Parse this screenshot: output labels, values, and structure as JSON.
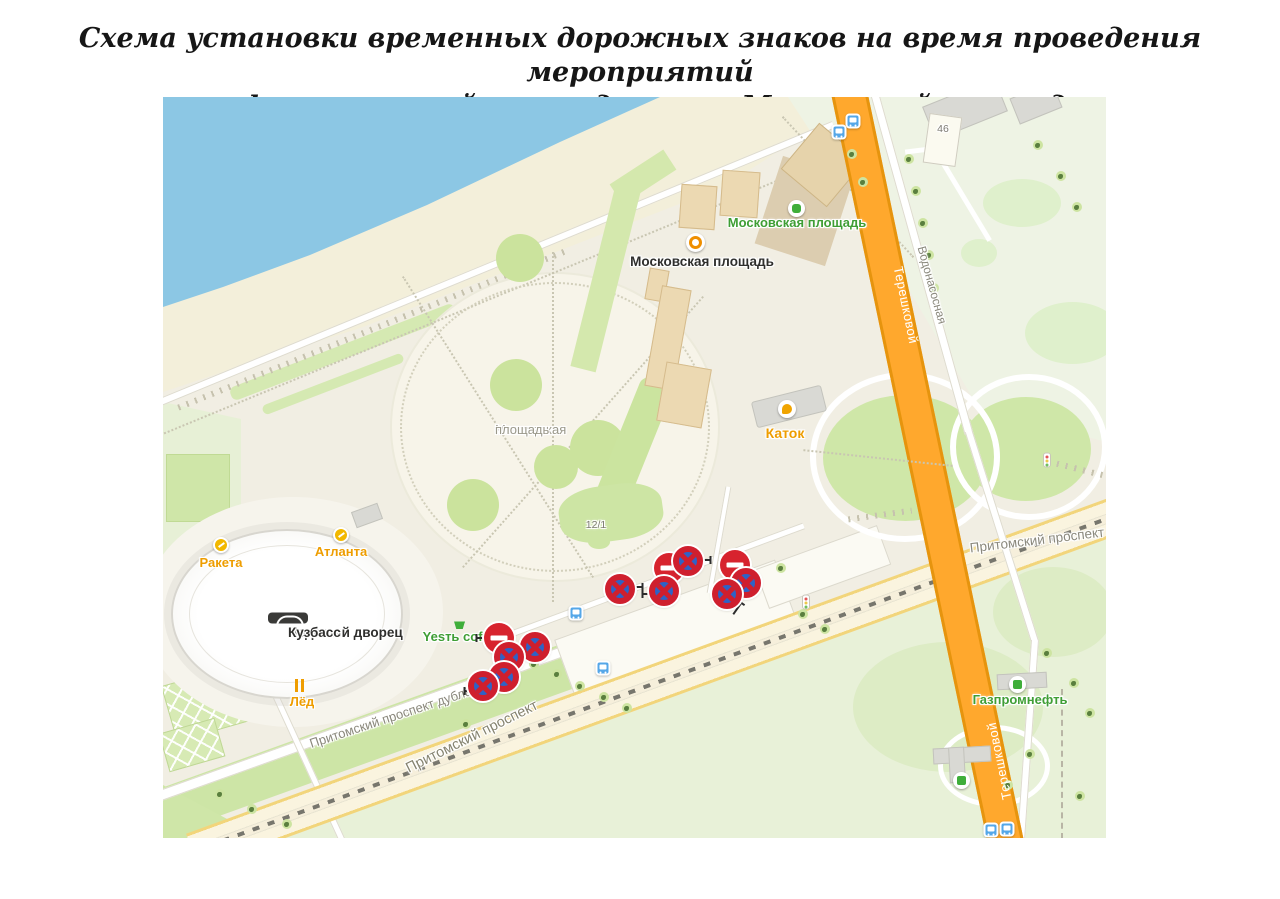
{
  "page": {
    "title_line1": "Схема установки временных дорожных знаков на время проведения мероприятий",
    "title_line2": "на фестивальной площади около Московской площади"
  },
  "map": {
    "poi": {
      "moskovskaya_green": "Московская площадь",
      "moskovskaya_black": "Московская площадь",
      "moskovskaya_plaza_line1": "Московская",
      "moskovskaya_plaza_line2": "площадь",
      "katok": "Каток",
      "raketa": "Ракета",
      "atlanta": "Атланта",
      "ledovy_line1": "Ледовый дворец",
      "ledovy_line2": "Кузбасс",
      "led": "Лёд",
      "yest_coffee": "Yesть coffee",
      "gazprom": "Газпромнефть",
      "house_46": "46",
      "house_12_1": "12/1"
    },
    "roads": {
      "tereshkovoy_top": "Терешковой",
      "tereshkovoy_bottom": "Терешковой",
      "vodonasosnaya": "Водонасосная",
      "pritomsky_dubler": "Притомский проспект дублёр",
      "pritomsky_left": "Притомский проспект",
      "pritomsky_right": "Притомский проспект"
    },
    "icons": {
      "moskovskaya_green_icon": "transit-stop",
      "moskovskaya_black_icon": "landmark-sight",
      "katok_icon": "ice-skate",
      "raketa_icon": "attraction",
      "atlanta_icon": "attraction",
      "led_icon": "restaurant-fork-knife",
      "yest_coffee_icon": "grocery-basket",
      "gazprom_icon": "fuel-station",
      "ledovy_icon": "stadium",
      "bus_stop_icon": "bus-stop",
      "traffic_light_icon": "traffic-light",
      "no_stopping_sign": "no-stopping (3.27)",
      "no_entry_sign": "no-entry (3.1)"
    },
    "road_signs": [
      {
        "type": "no-stopping",
        "x": 457,
        "y": 492
      },
      {
        "type": "no-entry",
        "x": 506,
        "y": 471
      },
      {
        "type": "no-stopping",
        "x": 525,
        "y": 464
      },
      {
        "type": "no-stopping",
        "x": 501,
        "y": 494
      },
      {
        "type": "no-entry",
        "x": 572,
        "y": 468
      },
      {
        "type": "no-stopping",
        "x": 583,
        "y": 486
      },
      {
        "type": "no-stopping",
        "x": 564,
        "y": 497
      },
      {
        "type": "no-entry",
        "x": 336,
        "y": 541
      },
      {
        "type": "no-stopping",
        "x": 372,
        "y": 550
      },
      {
        "type": "no-stopping",
        "x": 346,
        "y": 560
      },
      {
        "type": "no-stopping",
        "x": 341,
        "y": 580
      },
      {
        "type": "no-stopping",
        "x": 320,
        "y": 589
      }
    ],
    "sign_mounts": [
      [
        472,
        490,
        90
      ],
      [
        487,
        497,
        -90
      ],
      [
        540,
        463,
        90
      ],
      [
        574,
        512,
        35
      ],
      [
        357,
        552,
        -90
      ],
      [
        321,
        541,
        -90
      ],
      [
        309,
        594,
        -90
      ]
    ],
    "bus_stops": [
      [
        690,
        24
      ],
      [
        676,
        35
      ],
      [
        413,
        516
      ],
      [
        440,
        571
      ],
      [
        828,
        733
      ],
      [
        844,
        732
      ]
    ],
    "traffic_lights": [
      [
        643,
        505
      ],
      [
        884,
        363
      ]
    ],
    "trees": [
      [
        746,
        62
      ],
      [
        753,
        94
      ],
      [
        760,
        126
      ],
      [
        766,
        158
      ],
      [
        771,
        191
      ],
      [
        689,
        57
      ],
      [
        700,
        85
      ],
      [
        875,
        48
      ],
      [
        898,
        79
      ],
      [
        914,
        110
      ],
      [
        371,
        567
      ],
      [
        394,
        577
      ],
      [
        417,
        589
      ],
      [
        441,
        600
      ],
      [
        464,
        611
      ],
      [
        303,
        627
      ],
      [
        640,
        517
      ],
      [
        662,
        532
      ],
      [
        884,
        556
      ],
      [
        911,
        586
      ],
      [
        927,
        616
      ],
      [
        867,
        657
      ],
      [
        845,
        688
      ],
      [
        917,
        699
      ],
      [
        57,
        697
      ],
      [
        89,
        712
      ],
      [
        124,
        727
      ],
      [
        618,
        471
      ]
    ],
    "colors": {
      "water": "#8cc7e4",
      "beach": "#f3efda",
      "land": "#f1eee3",
      "park": "#e9f1da",
      "lawn": "#cfe6a6",
      "road_orange": "#ffa82d",
      "road_orange_casing": "#e6940e",
      "avenue_yellow": "#f2d57b",
      "sign_red": "#d7232e",
      "sign_blue": "#2f62c6",
      "label_green": "#3f9e35",
      "label_orange": "#ee9d00",
      "bus_blue": "#55a7e8"
    }
  }
}
